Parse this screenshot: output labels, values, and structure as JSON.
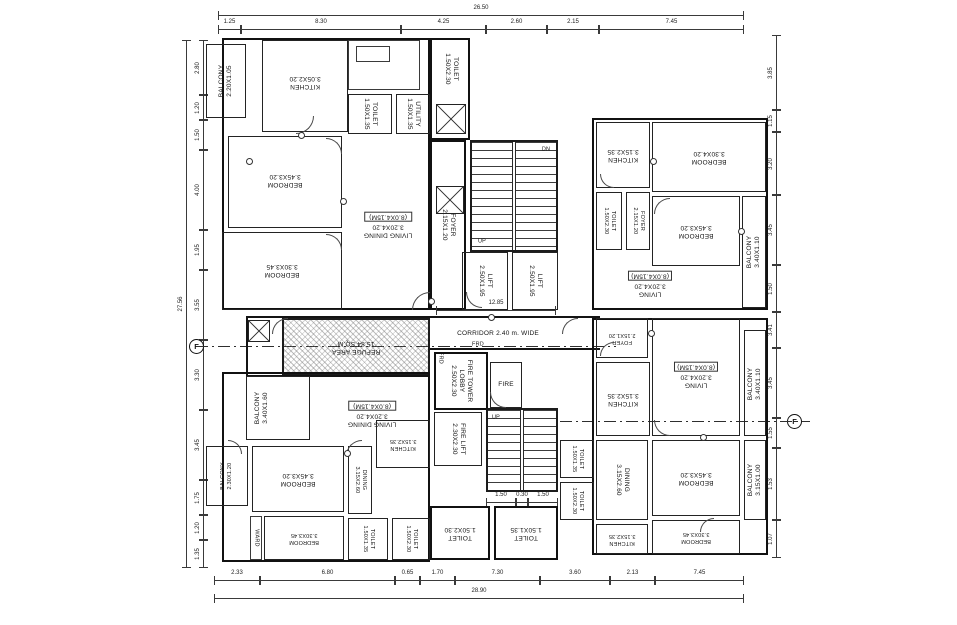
{
  "dims": {
    "top_total": "26.50",
    "top": [
      "1.25",
      "8.30",
      "4.25",
      "2.60",
      "2.15",
      "7.45"
    ],
    "bottom": [
      "2.33",
      "6.80",
      "0.65",
      "1.70",
      "7.30",
      "3.60",
      "2.13",
      "7.45"
    ],
    "bottom_total": "28.90",
    "left": [
      "2.80",
      "1.20",
      "1.50",
      "4.00",
      "1.95",
      "3.55",
      "3.30",
      "3.45",
      "1.75",
      "1.20",
      "1.35"
    ],
    "left_total": "27.56",
    "right": [
      "3.85",
      "1.15",
      "3.20",
      "3.45",
      "1.50",
      "3.41",
      "3.45",
      "1.55",
      "1.53",
      "1.07"
    ],
    "corridor": "12.85",
    "stair": [
      "1.50",
      "0.30",
      "1.50"
    ]
  },
  "markers": {
    "section_left": "F",
    "section_right": "F"
  },
  "core": {
    "lift1": {
      "name": "LIFT",
      "dim": "2.50X1.95"
    },
    "lift2": {
      "name": "LIFT",
      "dim": "2.50X1.95"
    },
    "fire_lobby": {
      "name": "FIRE TOWER LOBBY",
      "dim": "2.50X2.30"
    },
    "fire": {
      "name": "FIRE"
    },
    "fire_lift": {
      "name": "FIRE LIFT",
      "dim": "2.30X2.30"
    },
    "refuge": {
      "name": "REFUGE AREA",
      "dim": "15.84 SQ.M"
    },
    "corridor": {
      "name": "CORRIDOR 2.40 m. WIDE"
    },
    "frd_a": "FRD",
    "frd_b": "FRD",
    "stair_up": "UP",
    "stair_dn": "DN",
    "stair2_up": "UP"
  },
  "rooms": {
    "tl_balcony": {
      "name": "BALCONY",
      "dim": "2.20X1.05"
    },
    "tl_kitchen": {
      "name": "KITCHEN",
      "dim": "3.05X2.20"
    },
    "tl_bed1": {
      "name": "BEDROOM",
      "dim": "3.45X3.20"
    },
    "tl_bed2": {
      "name": "BEDROOM",
      "dim": "3.30X3.45"
    },
    "tl_toilet1": {
      "name": "TOILET",
      "dim": "1.50X1.35"
    },
    "tl_utility": {
      "name": "UTILITY",
      "dim": "1.50X1.35"
    },
    "tl_toilet2": {
      "name": "TOILET",
      "dim": "1.50X2.30"
    },
    "tl_foyer": {
      "name": "FOYER",
      "dim": "2.15X1.20"
    },
    "tl_living": {
      "name": "LIVING DINING",
      "dim": "3.20X4.20",
      "extra": "(8.0X4.15M)"
    },
    "tr_kitchen": {
      "name": "KITCHEN",
      "dim": "3.15X2.35"
    },
    "tr_toilet": {
      "name": "TOILET",
      "dim": "1.50X2.30"
    },
    "tr_foyer": {
      "name": "FOYER",
      "dim": "2.15X1.20"
    },
    "tr_bed1": {
      "name": "BEDROOM",
      "dim": "3.30X4.20"
    },
    "tr_bed2": {
      "name": "BEDROOM",
      "dim": "3.45X3.20"
    },
    "tr_balcony": {
      "name": "BALCONY",
      "dim": "3.40X1.10"
    },
    "tr_living": {
      "name": "LIVING",
      "dim": "3.20X4.20",
      "extra": "(8.0X4.15M)"
    },
    "mr_foyer": {
      "name": "FOYER",
      "dim": "2.15X1.20"
    },
    "mr_kitchen": {
      "name": "KITCHEN",
      "dim": "3.15X2.35"
    },
    "mr_living": {
      "name": "LIVING",
      "dim": "3.20X4.20",
      "extra": "(8.0X4.15M)"
    },
    "mr_balcony": {
      "name": "BALCONY",
      "dim": "3.40X1.10"
    },
    "br_bed1": {
      "name": "BEDROOM",
      "dim": "3.45X3.20"
    },
    "br_balcony": {
      "name": "BALCONY",
      "dim": "3.15X1.00"
    },
    "br_dining": {
      "name": "DINING",
      "dim": "3.15X2.60"
    },
    "br_bed2": {
      "name": "BEDROOM",
      "dim": "3.30X3.45"
    },
    "br_kitchen": {
      "name": "KITCHEN",
      "dim": "3.15X2.35"
    },
    "br_toilet1": {
      "name": "TOILET",
      "dim": "1.50X1.35"
    },
    "br_toilet2": {
      "name": "TOILET",
      "dim": "1.50X2.30"
    },
    "bl_balcony1": {
      "name": "BALCONY",
      "dim": "3.40X1.60"
    },
    "bl_balcony2": {
      "name": "BALCONY",
      "dim": "2.30X1.20"
    },
    "bl_living": {
      "name": "LIVING DINING",
      "dim": "3.20X4.20",
      "extra": "(8.0X4.15M)"
    },
    "bl_bed1": {
      "name": "BEDROOM",
      "dim": "3.45X3.20"
    },
    "bl_bed2": {
      "name": "BEDROOM",
      "dim": "3.30X3.45"
    },
    "bl_dining": {
      "name": "DINING",
      "dim": "3.15X2.60"
    },
    "bl_kitchen": {
      "name": "KITCHEN",
      "dim": "3.15X2.35"
    },
    "bl_ward": {
      "name": "WARD"
    },
    "bl_toilet1": {
      "name": "TOILET",
      "dim": "1.50X1.35"
    },
    "bl_toilet2": {
      "name": "TOILET",
      "dim": "1.50X2.30"
    },
    "bc_toilet1": {
      "name": "TOILET",
      "dim": "1.50X2.30"
    },
    "bc_toilet2": {
      "name": "TOILET",
      "dim": "1.50X1.35"
    }
  }
}
